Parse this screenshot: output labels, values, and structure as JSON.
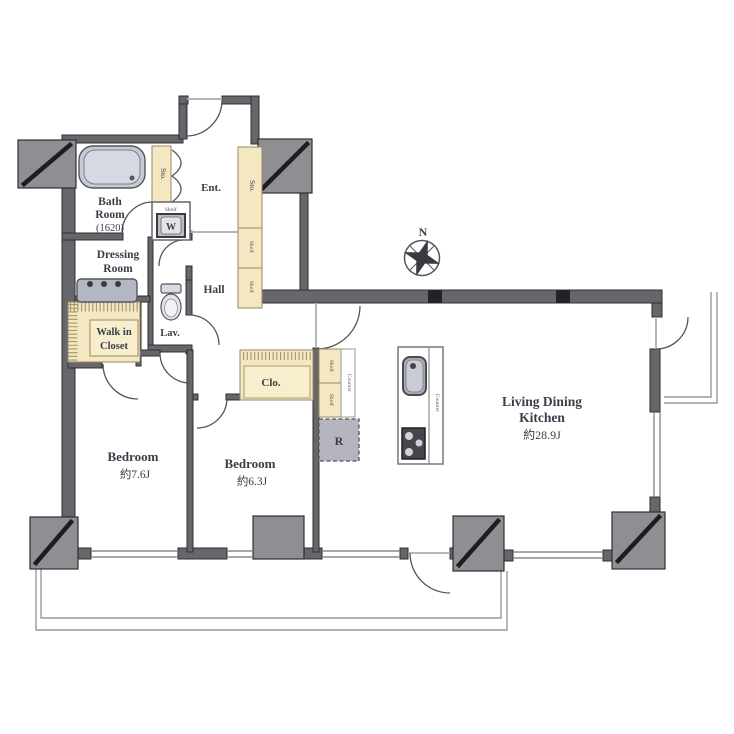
{
  "colors": {
    "wall": "#66666b",
    "pillar": "#8e8e93",
    "storage": "#f3e8c2",
    "storage_inner": "#f7eecd",
    "fixture": "#c6cad6",
    "appliance_gray": "#b5b5bf",
    "text": "#3c3c48"
  },
  "compass": {
    "north": "N"
  },
  "rooms": {
    "bath": {
      "line1": "Bath",
      "line2": "Room",
      "size": "(1620)"
    },
    "entrance": {
      "label": "Ent."
    },
    "hall": {
      "label": "Hall"
    },
    "dressing": {
      "line1": "Dressing",
      "line2": "Room"
    },
    "walk_in_closet": {
      "line1": "Walk in",
      "line2": "Closet"
    },
    "lavatory": {
      "label": "Lav."
    },
    "closet": {
      "label": "Clo."
    },
    "bedroom1": {
      "name": "Bedroom",
      "size": "約7.6J"
    },
    "bedroom2": {
      "name": "Bedroom",
      "size": "約6.3J"
    },
    "ldk": {
      "line1": "Living Dining",
      "line2": "Kitchen",
      "size": "約28.9J"
    }
  },
  "storage": {
    "sto_bath": "Sto.",
    "sto_entry": "Sto.",
    "shelf_entry_upper": "Shelf",
    "shelf_entry_lower": "Shelf",
    "shelf_laundry": "Shelf",
    "shelf_kitchen_upper": "Shelf",
    "shelf_kitchen_lower": "Shelf"
  },
  "kitchen": {
    "counter_wall": "Counter",
    "counter_island": "Counter",
    "refrigerator": "R"
  },
  "laundry": {
    "washer": "W"
  }
}
